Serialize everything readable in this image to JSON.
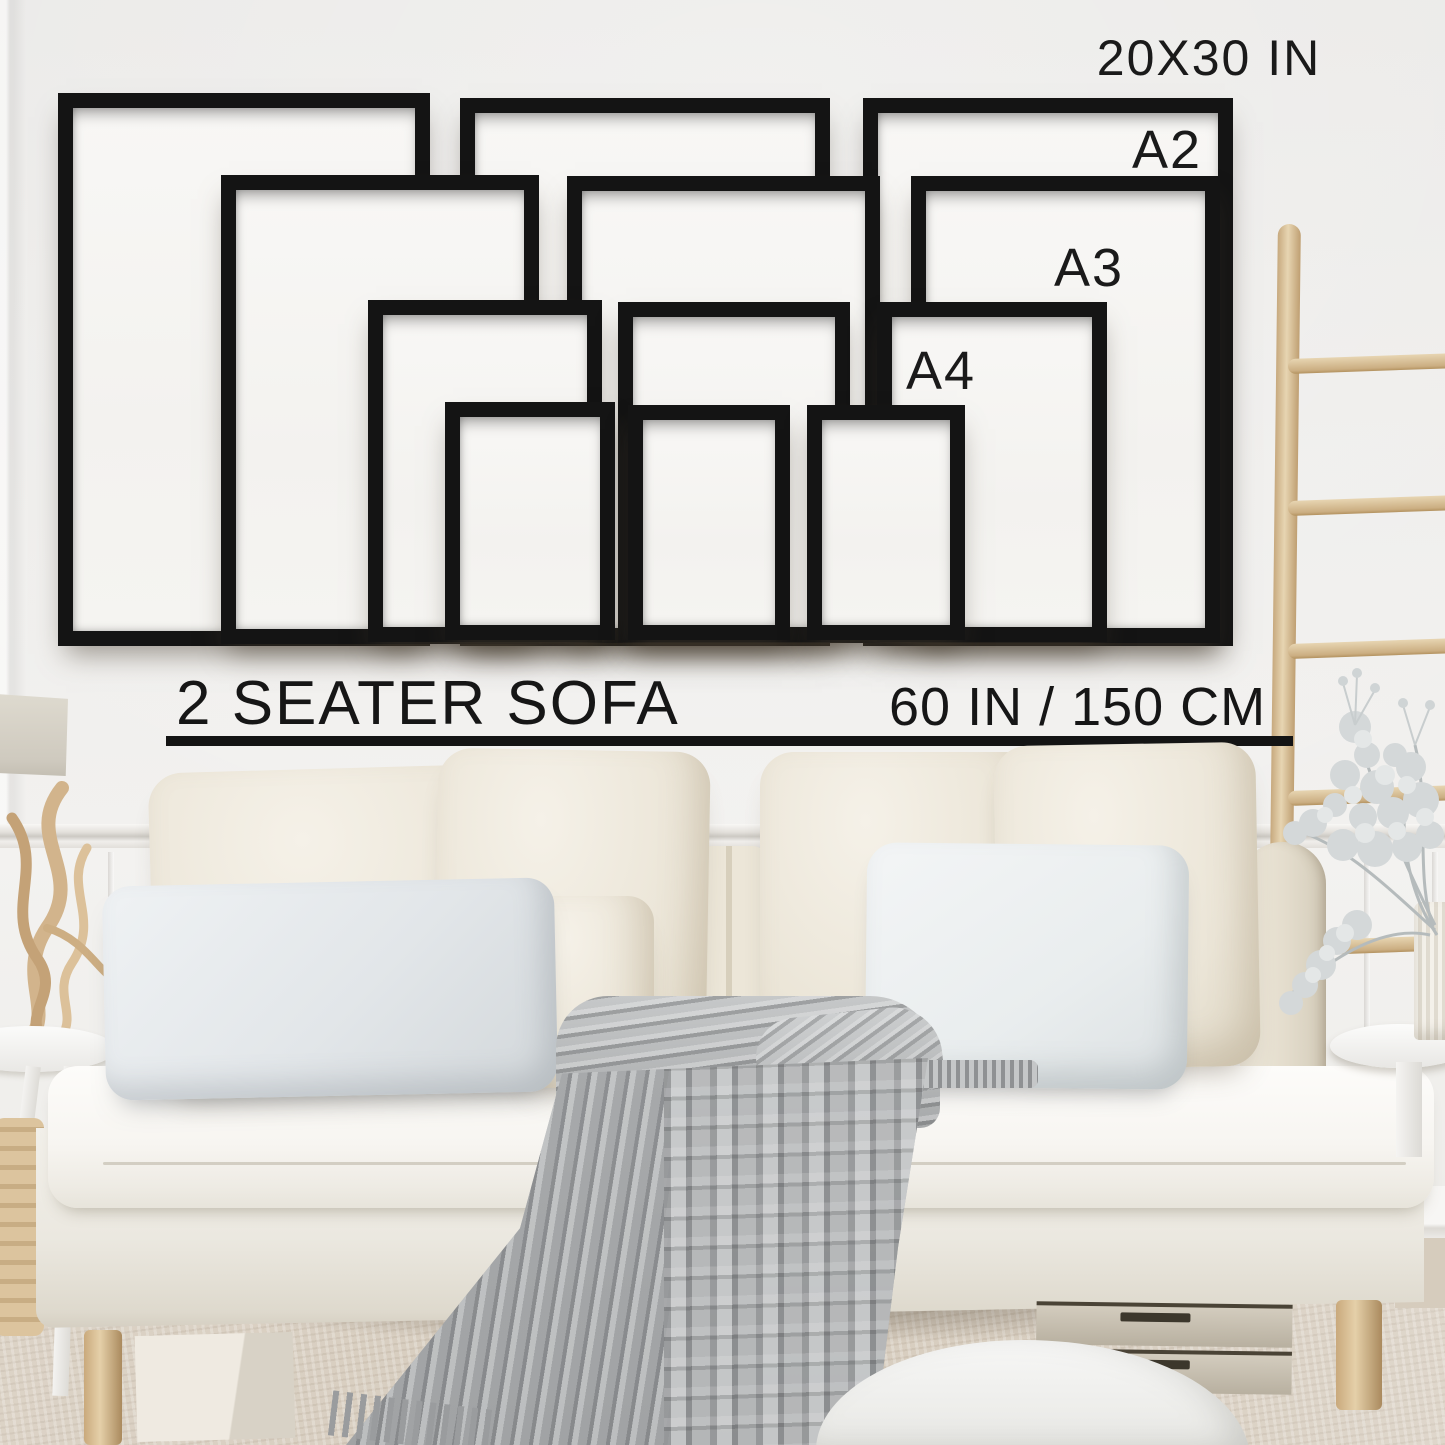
{
  "texts": {
    "sofa_label": "2 SEATER SOFA",
    "sofa_width": "60 IN / 150 CM"
  },
  "size_guide": {
    "frame_color": "#141414",
    "mat_color": "#f6f5f3",
    "frames": [
      {
        "id": "20x30-left",
        "size": "20X30 IN",
        "x": 58,
        "y": 93,
        "w": 372,
        "h": 553
      },
      {
        "id": "20x30-center",
        "size": "20X30 IN",
        "x": 460,
        "y": 98,
        "w": 370,
        "h": 548
      },
      {
        "id": "20x30-right",
        "size": "20X30 IN",
        "x": 863,
        "y": 98,
        "w": 370,
        "h": 548
      },
      {
        "id": "a2-left",
        "size": "A2",
        "x": 221,
        "y": 175,
        "w": 318,
        "h": 469
      },
      {
        "id": "a2-center",
        "size": "A2",
        "x": 567,
        "y": 176,
        "w": 313,
        "h": 467
      },
      {
        "id": "a2-right",
        "size": "A2",
        "x": 911,
        "y": 176,
        "w": 309,
        "h": 467
      },
      {
        "id": "a3-left",
        "size": "A3",
        "x": 368,
        "y": 300,
        "w": 234,
        "h": 342
      },
      {
        "id": "a3-center",
        "size": "A3",
        "x": 618,
        "y": 302,
        "w": 232,
        "h": 340
      },
      {
        "id": "a3-right",
        "size": "A3",
        "x": 877,
        "y": 302,
        "w": 230,
        "h": 340
      },
      {
        "id": "a4-left",
        "size": "A4",
        "x": 445,
        "y": 402,
        "w": 170,
        "h": 238
      },
      {
        "id": "a4-center",
        "size": "A4",
        "x": 628,
        "y": 405,
        "w": 162,
        "h": 235
      },
      {
        "id": "a4-right",
        "size": "A4",
        "x": 807,
        "y": 405,
        "w": 158,
        "h": 235
      }
    ],
    "labels": [
      {
        "text": "20X30 IN",
        "cx": 1209,
        "cy": 58,
        "fs": 50
      },
      {
        "text": "A2",
        "cx": 1167,
        "cy": 150,
        "fs": 54
      },
      {
        "text": "A3",
        "cx": 1089,
        "cy": 268,
        "fs": 54
      },
      {
        "text": "A4",
        "cx": 941,
        "cy": 371,
        "fs": 54
      }
    ]
  },
  "scale_bar": {
    "line": {
      "x": 166,
      "y": 736,
      "w": 1127,
      "h": 10
    }
  },
  "room": {
    "ladder_rungs_y": [
      356,
      498,
      641,
      788,
      938
    ],
    "colors": {
      "wall": "#efeeec",
      "wainscot": "#f3f2f0",
      "carpet": "#d8cec0",
      "frame_black": "#141414",
      "text": "#171717",
      "sofa_fabric": "#f4f2ec",
      "cream_pillow": "#ebe5d7",
      "gray_pillow": "#e2e6e9",
      "blanket_gray": "#a7a9aa",
      "ladder_wood": "#d9c098",
      "plant_foliage": "#d4d8d9",
      "vase": "#efece4"
    }
  }
}
